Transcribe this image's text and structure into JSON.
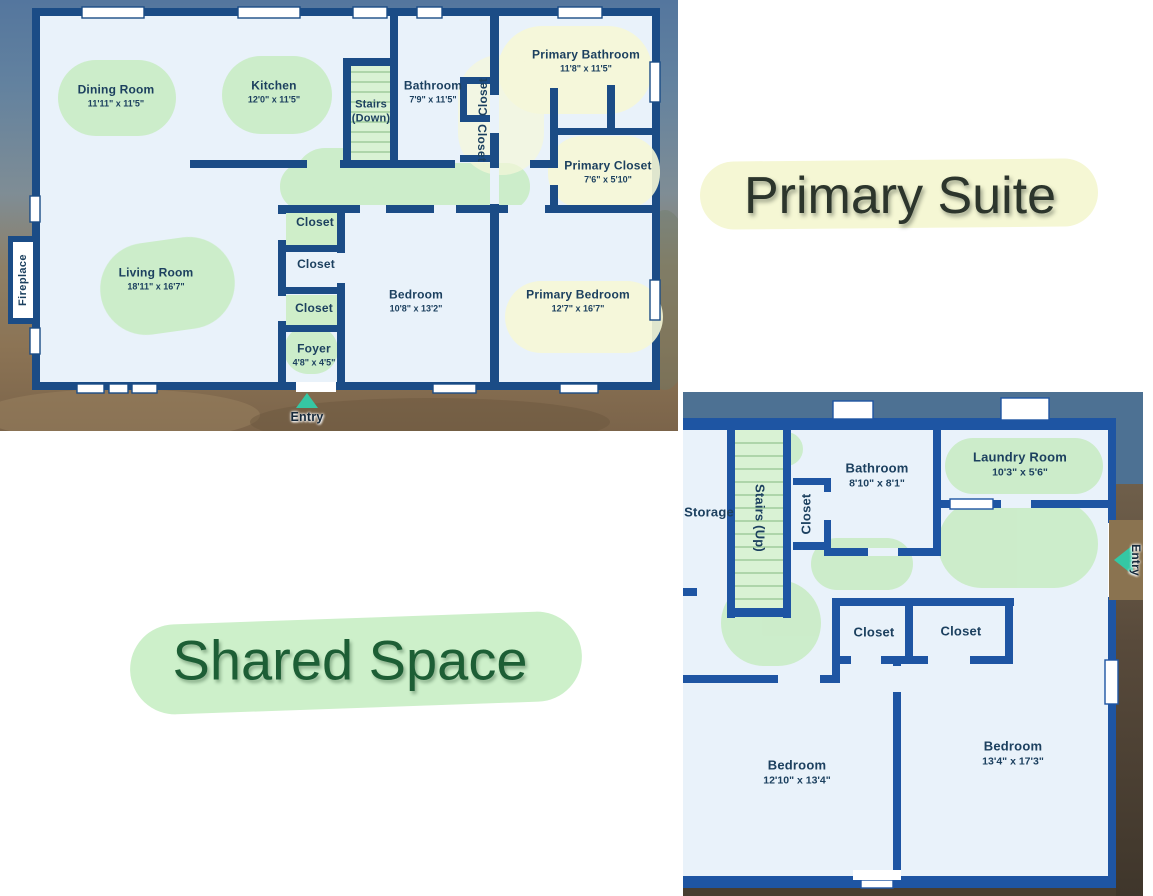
{
  "annotations": {
    "primary_suite": "Primary Suite",
    "shared_space": "Shared Space"
  },
  "floor1": {
    "fireplace_label": "Fireplace",
    "entry_label": "Entry",
    "rooms": {
      "dining": {
        "name": "Dining Room",
        "dims": "11'11\" x 11'5\""
      },
      "kitchen": {
        "name": "Kitchen",
        "dims": "12'0\" x 11'5\""
      },
      "stairs": {
        "name": "Stairs (Down)"
      },
      "bathroom": {
        "name": "Bathroom",
        "dims": "7'9\" x 11'5\""
      },
      "closet_upper": {
        "name": "Closet"
      },
      "closet_lower": {
        "name": "Closet"
      },
      "primary_bathroom": {
        "name": "Primary Bathroom",
        "dims": "11'8\" x 11'5\""
      },
      "primary_closet": {
        "name": "Primary Closet",
        "dims": "7'6\" x 5'10\""
      },
      "living": {
        "name": "Living Room",
        "dims": "18'11\" x 16'7\""
      },
      "closet_1": {
        "name": "Closet"
      },
      "closet_2": {
        "name": "Closet"
      },
      "closet_3": {
        "name": "Closet"
      },
      "foyer": {
        "name": "Foyer",
        "dims": "4'8\" x 4'5\""
      },
      "bedroom": {
        "name": "Bedroom",
        "dims": "10'8\" x 13'2\""
      },
      "primary_bedroom": {
        "name": "Primary Bedroom",
        "dims": "12'7\" x 16'7\""
      }
    }
  },
  "floor2": {
    "entry_label": "Entry",
    "rooms": {
      "storage": {
        "name": "Storage"
      },
      "stairs": {
        "name": "Stairs (Up)"
      },
      "closet_hall": {
        "name": "Closet"
      },
      "bathroom": {
        "name": "Bathroom",
        "dims": "8'10\" x 8'1\""
      },
      "laundry": {
        "name": "Laundry Room",
        "dims": "10'3\" x 5'6\""
      },
      "closet_left": {
        "name": "Closet"
      },
      "closet_right": {
        "name": "Closet"
      },
      "bedroom_left": {
        "name": "Bedroom",
        "dims": "12'10\" x 13'4\""
      },
      "bedroom_right": {
        "name": "Bedroom",
        "dims": "13'4\" x 17'3\""
      }
    }
  },
  "colors": {
    "wall_floor1": "#1b4c86",
    "wall_floor2": "#1e55a3",
    "floor_fill": "#e9f2fa",
    "green_highlight": "#c9ecc5",
    "yellow_highlight": "#f6f8d6",
    "teal_accent": "#35c7a4",
    "roof_band": "#4d7193"
  }
}
